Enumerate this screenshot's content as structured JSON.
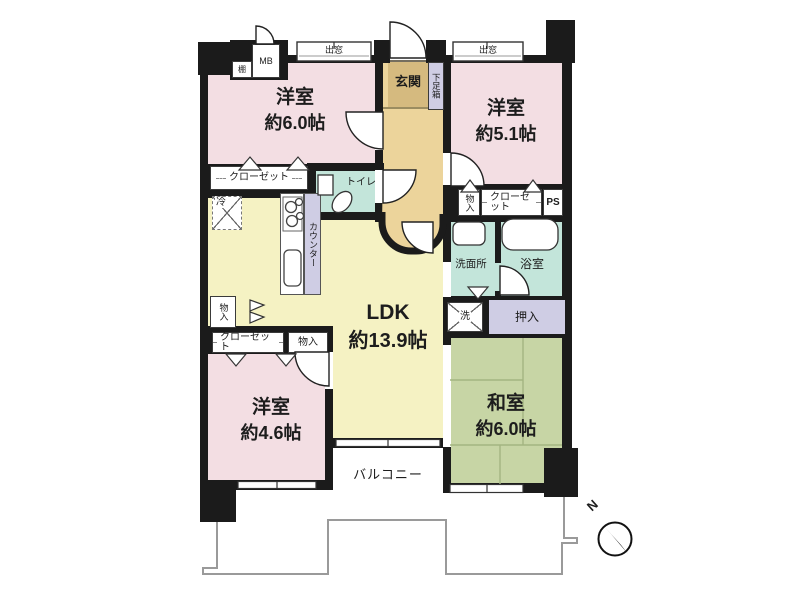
{
  "rooms": {
    "bedroom_nw": {
      "name": "洋室",
      "size": "約6.0帖"
    },
    "bedroom_ne": {
      "name": "洋室",
      "size": "約5.1帖"
    },
    "bedroom_sw": {
      "name": "洋室",
      "size": "約4.6帖"
    },
    "washitsu": {
      "name": "和室",
      "size": "約6.0帖"
    },
    "ldk": {
      "name": "LDK",
      "size": "約13.9帖"
    },
    "entrance": "玄関",
    "toilet": "トイレ",
    "washroom": "洗面所",
    "bathroom": "浴室",
    "balcony": "バルコニー"
  },
  "fixtures": {
    "closet": "クローゼット",
    "shoe_box": "下足箱",
    "oshiire": "押入",
    "washer": "洗",
    "storage": "物入",
    "counter": "カウンター",
    "fridge": "冷",
    "meter_box": "MB",
    "pipe_space": "PS",
    "shelf": "棚",
    "bay_window": "出窓"
  },
  "compass": {
    "north": "N"
  },
  "colors": {
    "wall": "#1b1b1b",
    "western_room": "#f3dee3",
    "ldk": "#f5f2c3",
    "tatami": "#c7d5a5",
    "wet_area": "#c3e5da",
    "closet_area": "#cfcde4",
    "entrance": "#d5ba7f",
    "hallway": "#ecd49b",
    "balcony_line": "#9a9a9a"
  }
}
